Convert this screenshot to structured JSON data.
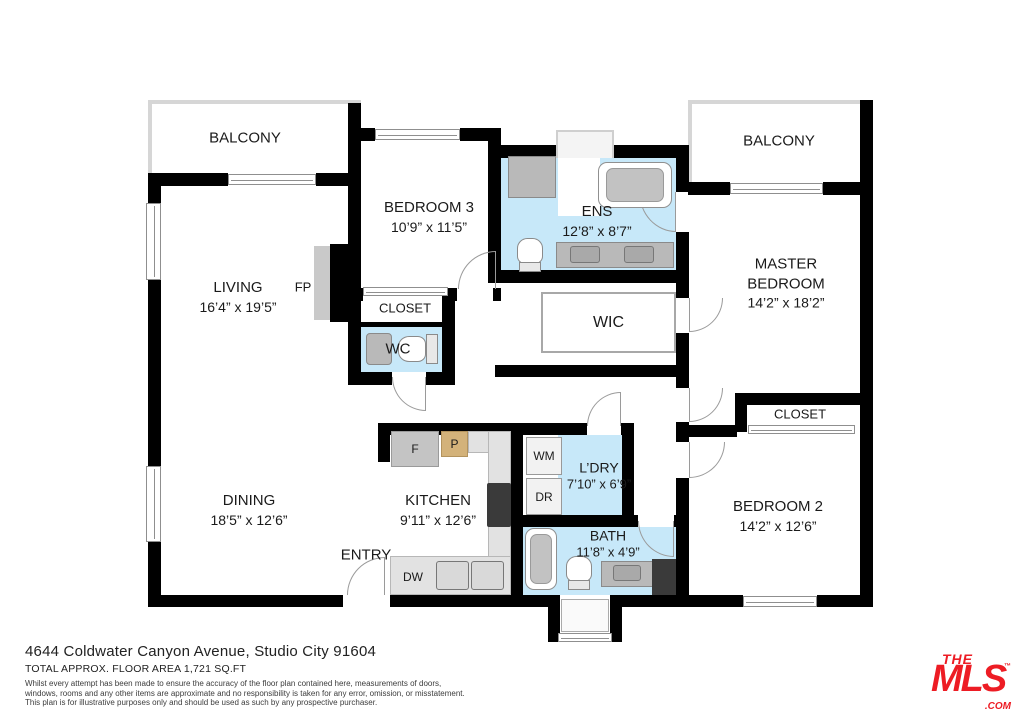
{
  "rooms": {
    "balcony_left": {
      "name": "BALCONY"
    },
    "balcony_right": {
      "name": "BALCONY"
    },
    "living": {
      "name": "LIVING",
      "dims": "16’4” x 19’5”"
    },
    "fireplace": {
      "name": "FP"
    },
    "bedroom3": {
      "name": "BEDROOM 3",
      "dims": "10’9” x 11’5”"
    },
    "closet_bedroom3": {
      "name": "CLOSET"
    },
    "wc": {
      "name": "WC"
    },
    "ens": {
      "name": "ENS",
      "dims": "12’8” x 8’7”"
    },
    "wic": {
      "name": "WIC"
    },
    "master": {
      "name": "MASTER BEDROOM",
      "dims": "14’2” x 18’2”"
    },
    "closet_master": {
      "name": "CLOSET"
    },
    "bedroom2": {
      "name": "BEDROOM 2",
      "dims": "14’2” x 12’6”"
    },
    "dining": {
      "name": "DINING",
      "dims": "18’5” x 12’6”"
    },
    "kitchen": {
      "name": "KITCHEN",
      "dims": "9’11” x 12’6”"
    },
    "entry": {
      "name": "ENTRY"
    },
    "laundry": {
      "name": "L’DRY",
      "dims": "7’10” x 6’9”"
    },
    "bath": {
      "name": "BATH",
      "dims": "11’8” x 4’9”"
    }
  },
  "appliances": {
    "fridge": "F",
    "pantry": "P",
    "dishwasher": "DW",
    "washer": "WM",
    "dryer": "DR"
  },
  "footer": {
    "address": "4644 Coldwater Canyon Avenue, Studio City 91604",
    "area": "TOTAL APPROX. FLOOR AREA 1,721 SQ.FT",
    "disclaimer_line1": "Whilst every attempt has been made to ensure the accuracy of the floor plan contained here, measurements of doors,",
    "disclaimer_line2": "windows, rooms and any other items are approximate and no responsibility is taken for any error, omission, or misstatement.",
    "disclaimer_line3": "This plan is for illustrative purposes only and should be used as such by any prospective purchaser."
  },
  "logo": {
    "the": "THE",
    "mls": "MLS",
    "tm": "™",
    "com": ".COM"
  },
  "colors": {
    "wet_area_fill": "#c7e8f9",
    "wall": "#000000",
    "logo_red": "#ED1C24"
  }
}
